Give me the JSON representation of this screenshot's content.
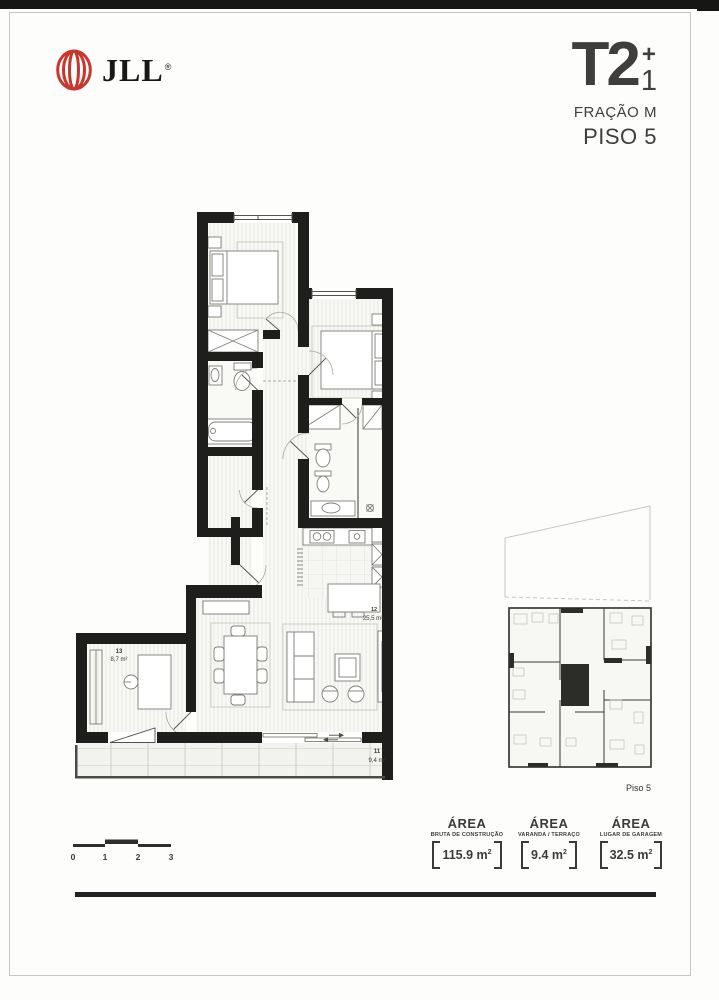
{
  "logo": {
    "text": "JLL",
    "reg": "®",
    "color": "#c8362e"
  },
  "title": {
    "type": "T2",
    "plus": "+",
    "plus_n": "1",
    "fraction": "FRAÇÃO M",
    "floor": "PISO 5"
  },
  "plan": {
    "r13": {
      "num": "13",
      "area": "8,7 m²"
    },
    "r12": {
      "num": "12",
      "area": "25,5 m²"
    },
    "r11": {
      "num": "11",
      "area": "9,4 m²"
    }
  },
  "key_plan": {
    "caption": "Piso 5"
  },
  "scale_bar": {
    "ticks": [
      "0",
      "1",
      "2",
      "3"
    ]
  },
  "areas": [
    {
      "title": "ÁREA",
      "subtitle": "BRUTA DE CONSTRUÇÃO",
      "value": "115.9",
      "unit": " m",
      "sup": "2"
    },
    {
      "title": "ÁREA",
      "subtitle": "VARANDA / TERRAÇO",
      "value": "9.4",
      "unit": " m",
      "sup": "2"
    },
    {
      "title": "ÁREA",
      "subtitle": "LUGAR DE GARAGEM",
      "value": "32.5",
      "unit": " m",
      "sup": "2"
    }
  ],
  "colors": {
    "wall": "#1e1e1c",
    "text_dark": "#3b3b38",
    "logo_red": "#c8362e"
  }
}
